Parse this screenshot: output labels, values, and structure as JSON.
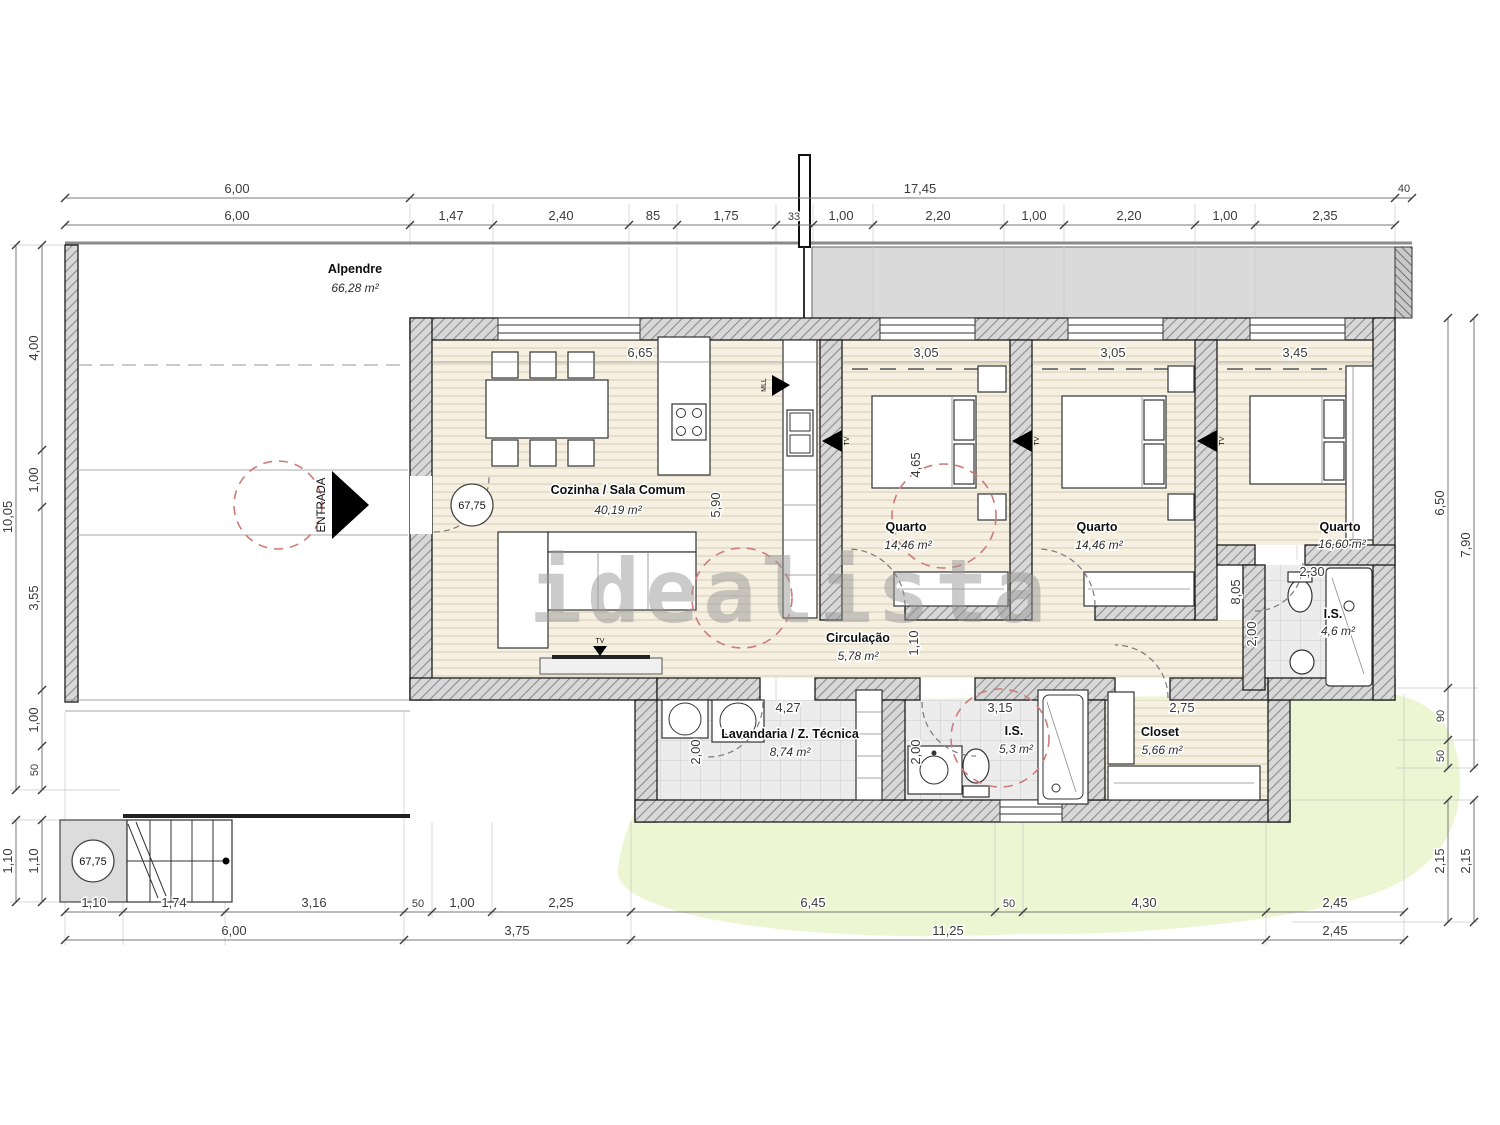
{
  "watermark": "idealista",
  "labels": {
    "entrance": "ENTRADA",
    "tv": "TV",
    "appliance": "MLL"
  },
  "levels": {
    "entrance": "67,75",
    "stairs": "67,75"
  },
  "rooms": {
    "alpendre": {
      "name": "Alpendre",
      "area": "66,28 m²"
    },
    "cozinha": {
      "name": "Cozinha / Sala Comum",
      "area": "40,19 m²"
    },
    "quarto1": {
      "name": "Quarto",
      "area": "14,46 m²"
    },
    "quarto2": {
      "name": "Quarto",
      "area": "14,46 m²"
    },
    "quarto3": {
      "name": "Quarto",
      "area": "16,60 m²"
    },
    "is1": {
      "name": "I.S.",
      "area": "4,6 m²"
    },
    "is2": {
      "name": "I.S.",
      "area": "5,3 m²"
    },
    "closet": {
      "name": "Closet",
      "area": "5,66 m²"
    },
    "lavandaria": {
      "name": "Lavandaria / Z. Técnica",
      "area": "8,74 m²"
    },
    "circulacao": {
      "name": "Circulação",
      "area": "5,78 m²"
    }
  },
  "dims": {
    "top1": [
      "6,00",
      "17,45",
      "40"
    ],
    "top2": [
      "6,00",
      "1,47",
      "2,40",
      "85",
      "1,75",
      "33",
      "1,00",
      "2,20",
      "1,00",
      "2,20",
      "1,00",
      "2,35"
    ],
    "left_outer": [
      "10,05",
      "1,10"
    ],
    "left_inner": [
      "4,00",
      "1,00",
      "3,55",
      "1,00",
      "50",
      "1,10"
    ],
    "right_inner": [
      "6,50",
      "90",
      "50",
      "2,15"
    ],
    "right_outer": [
      "7,90",
      "2,15"
    ],
    "bottom1": [
      "1,10",
      "1,74",
      "3,16",
      "50",
      "1,00",
      "2,25",
      "6,45",
      "50",
      "4,30",
      "2,45"
    ],
    "bottom2": [
      "6,00",
      "3,75",
      "11,25",
      "2,45"
    ],
    "interior": {
      "kitchen_w": "6,65",
      "q1_w": "3,05",
      "q2_w": "3,05",
      "q3_w": "3,45",
      "kitchen_h": "5,90",
      "q1_h": "4,65",
      "corridor": "1,10",
      "right_h": "8,05",
      "is1_w": "2,30",
      "is1_h": "2,00",
      "lav_w": "4,27",
      "lav_h": "2,00",
      "is2_w": "3,15",
      "is2_h": "2,00",
      "closet_w": "2,75"
    }
  }
}
